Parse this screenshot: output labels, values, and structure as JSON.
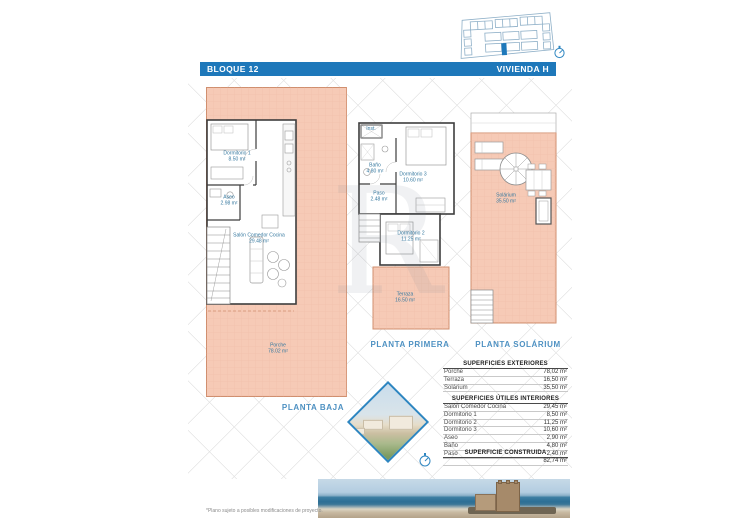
{
  "header": {
    "block": "BLOQUE 12",
    "unit": "VIVIENDA H"
  },
  "icons": {
    "compass": "circle-with-needle",
    "site_plan": "block-overview-with-highlighted-unit"
  },
  "plans": {
    "baja": {
      "title": "PLANTA BAJA",
      "rooms": {
        "dormitorio1": {
          "name": "Dormitorio 1",
          "area": "8.50 m²"
        },
        "aseo": {
          "name": "Aseo",
          "area": "2.98 m²"
        },
        "salon": {
          "name": "Salón Comedor Cocina",
          "area": "29.48 m²"
        },
        "porche": {
          "name": "Porche",
          "area": "78.02 m²"
        }
      }
    },
    "primera": {
      "title": "PLANTA PRIMERA",
      "rooms": {
        "inst": {
          "name": "Inst."
        },
        "bano": {
          "name": "Baño",
          "area": "4.80 m²"
        },
        "dormitorio3": {
          "name": "Dormitorio 3",
          "area": "10.60 m²"
        },
        "paso": {
          "name": "Paso",
          "area": "2.48 m²"
        },
        "dormitorio2": {
          "name": "Dormitorio 2",
          "area": "11.25 m²"
        },
        "terraza": {
          "name": "Terraza",
          "area": "16.50 m²"
        }
      }
    },
    "solarium": {
      "title": "PLANTA SOLÁRIUM",
      "rooms": {
        "solarium": {
          "name": "Solárium",
          "area": "35.50 m²"
        }
      }
    }
  },
  "tables": {
    "exteriores": {
      "title": "SUPERFICIES EXTERIORES",
      "rows": [
        {
          "label": "Porche",
          "value": "78,02 m²"
        },
        {
          "label": "Terraza",
          "value": "16,50 m²"
        },
        {
          "label": "Solárium",
          "value": "35,50 m²"
        }
      ]
    },
    "interiores": {
      "title": "SUPERFICIES ÚTILES INTERIORES",
      "rows": [
        {
          "label": "Salón Comedor Cocina",
          "value": "29,45 m²"
        },
        {
          "label": "Dormitorio 1",
          "value": "8,50 m²"
        },
        {
          "label": "Dormitorio 2",
          "value": "11,25 m²"
        },
        {
          "label": "Dormitorio 3",
          "value": "10,60 m²"
        },
        {
          "label": "Aseo",
          "value": "2,90 m²"
        },
        {
          "label": "Baño",
          "value": "4,80 m²"
        },
        {
          "label": "Paso",
          "value": "2,40 m²"
        }
      ]
    },
    "construida": {
      "title": "SUPERFICIE CONSTRUIDA",
      "value": "82,74 m²"
    }
  },
  "footnote": "*Plano sujeto a posibles modificaciones de proyecto.",
  "colors": {
    "accent_blue": "#1e78ba",
    "title_blue": "#4e91c2",
    "terrace_fill": "#f6cab6",
    "terrace_line": "#d08f6f"
  }
}
